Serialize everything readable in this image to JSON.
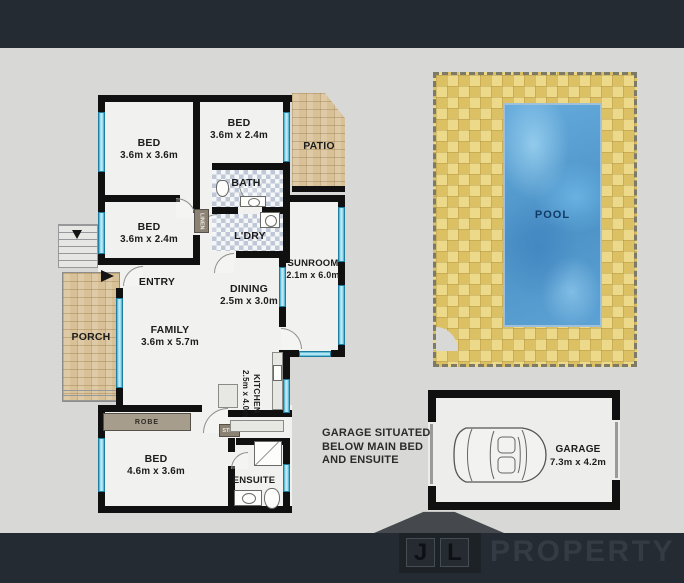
{
  "colors": {
    "letterbox_bar": "#242b32",
    "canvas": "#d8d8d6",
    "wall": "#101010",
    "window_glass": "#a5e0f0",
    "room_floor": "#f1f2ef",
    "brick": "#d9c197",
    "pool_deck": "#dcc064",
    "pool_water": "#4c92c6",
    "logo_wordmark": "#353b43"
  },
  "plan": {
    "bed1": {
      "name": "BED",
      "dims": "3.6m x 3.6m"
    },
    "bed2": {
      "name": "BED",
      "dims": "3.6m x 2.4m"
    },
    "bed3": {
      "name": "BED",
      "dims": "3.6m x 2.4m"
    },
    "bed4": {
      "name": "BED",
      "dims": "4.6m x 3.6m"
    },
    "bath": {
      "name": "BATH"
    },
    "laundry": {
      "name": "L'DRY"
    },
    "linen": {
      "name": "LINEN"
    },
    "entry": {
      "name": "ENTRY"
    },
    "dining": {
      "name": "DINING",
      "dims": "2.5m x 3.0m"
    },
    "family": {
      "name": "FAMILY",
      "dims": "3.6m x 5.7m"
    },
    "kitchen": {
      "name": "KITCHEN",
      "dims": "2.5m x 4.0m"
    },
    "sunroom": {
      "name": "SUNROOM",
      "dims": "2.1m x 6.0m"
    },
    "porch": {
      "name": "PORCH"
    },
    "patio": {
      "name": "PATIO"
    },
    "robe": {
      "name": "ROBE"
    },
    "step": {
      "name": "STEP"
    },
    "ensuite": {
      "name": "ENSUITE"
    },
    "pool": {
      "name": "POOL"
    },
    "garage": {
      "name": "GARAGE",
      "dims": "7.3m x 4.2m"
    }
  },
  "note": {
    "lines": [
      "GARAGE SITUATED",
      "BELOW MAIN BED",
      "AND ENSUITE"
    ]
  },
  "logo": {
    "letter_j": "J",
    "letter_l": "L",
    "wordmark": "PROPERTY"
  }
}
